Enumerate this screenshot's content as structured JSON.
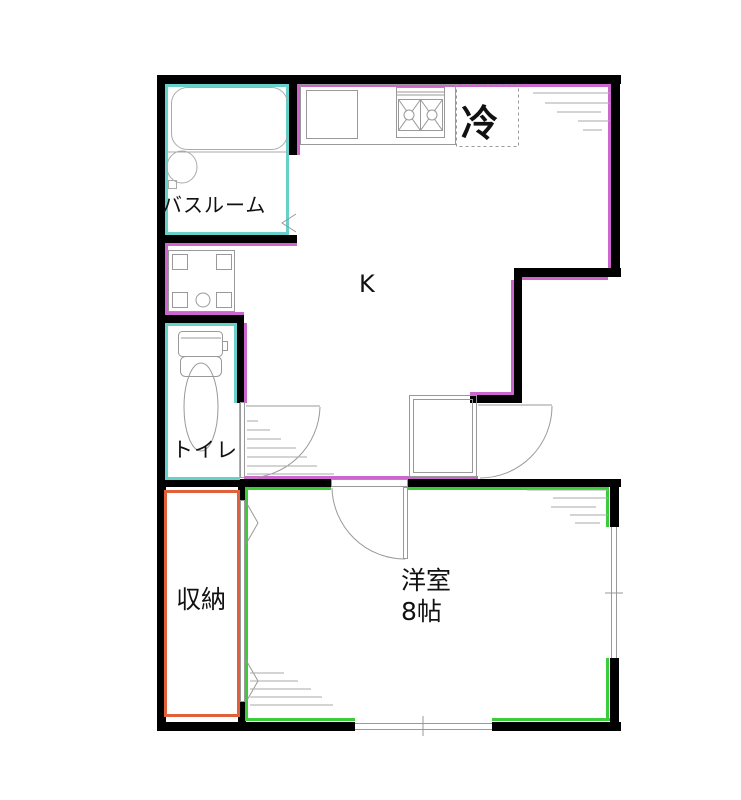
{
  "plan": {
    "type": "apartment-floor-plan",
    "rooms": {
      "bathroom": {
        "label": "バスルーム",
        "border_color": "#66d0ca"
      },
      "toilet": {
        "label": "トイレ",
        "border_color": "#66d0ca"
      },
      "kitchen": {
        "label": "K",
        "border_color": "#cc66cc"
      },
      "storage": {
        "label": "収納",
        "border_color": "#e0603a"
      },
      "western_room": {
        "label_line1": "洋室",
        "label_line2": "8帖",
        "border_color": "#3acc3a"
      }
    },
    "fixtures": {
      "refrigerator": {
        "label": "冷"
      }
    },
    "colors": {
      "wall": "#000000",
      "wet_area_border": "#66d0ca",
      "kitchen_border": "#cc66cc",
      "storage_border": "#e0603a",
      "western_room_border": "#3acc3a",
      "linework": "#999999"
    }
  }
}
